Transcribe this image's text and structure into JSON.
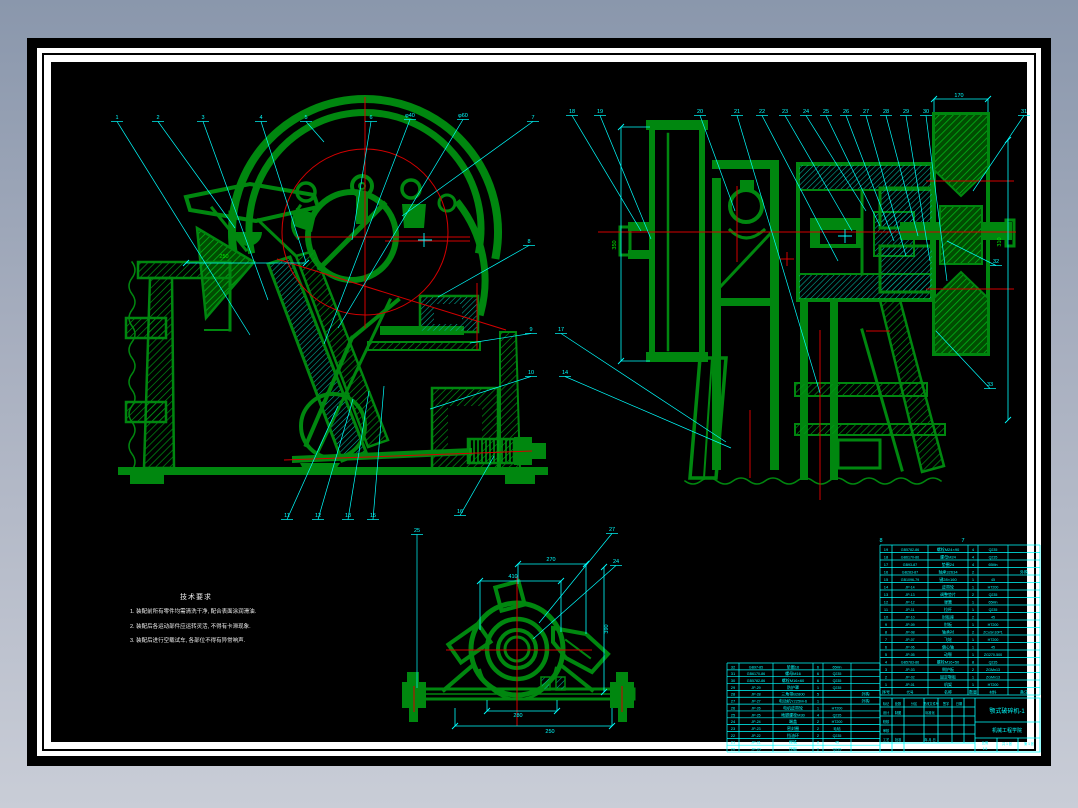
{
  "colors": {
    "green": "#00870f",
    "bright_green": "#00e800",
    "red": "#d40000",
    "cyan": "#00ffff",
    "white": "#f2f2f2",
    "desktop_top": "#8a97ac",
    "desktop_bottom": "#c9cdd7",
    "paper": "#000000"
  },
  "notes": {
    "title": "技术要求",
    "lines": [
      "1. 装配前所有零件均需清洗干净, 配合表面涂润滑油.",
      "2. 装配后各运动部件应运转灵活, 不得有卡滞现象.",
      "3. 装配后进行空载试车, 各部位不得有异常响声."
    ]
  },
  "callouts": [
    {
      "t": "1",
      "x": 117,
      "y": 119,
      "ex": 250,
      "ey": 335
    },
    {
      "t": "2",
      "x": 158,
      "y": 119,
      "ex": 235,
      "ey": 228
    },
    {
      "t": "3",
      "x": 203,
      "y": 119,
      "ex": 268,
      "ey": 300
    },
    {
      "t": "4",
      "x": 261,
      "y": 119,
      "ex": 306,
      "ey": 262
    },
    {
      "t": "5",
      "x": 306,
      "y": 119,
      "ex": 324,
      "ey": 142
    },
    {
      "t": "6",
      "x": 371,
      "y": 119,
      "ex": 352,
      "ey": 240
    },
    {
      "t": "φ40",
      "x": 410,
      "y": 117,
      "ex": 324,
      "ey": 344
    },
    {
      "t": "φ60",
      "x": 463,
      "y": 117,
      "ex": 338,
      "ey": 328
    },
    {
      "t": "7",
      "x": 533,
      "y": 119,
      "ex": 402,
      "ey": 216
    },
    {
      "t": "8",
      "x": 529,
      "y": 243,
      "ex": 438,
      "ey": 297
    },
    {
      "t": "9",
      "x": 531,
      "y": 331,
      "ex": 470,
      "ey": 343
    },
    {
      "t": "10",
      "x": 531,
      "y": 374,
      "ex": 430,
      "ey": 409
    },
    {
      "t": "17",
      "x": 561,
      "y": 331,
      "ex": 726,
      "ey": 442
    },
    {
      "t": "14",
      "x": 565,
      "y": 374,
      "ex": 731,
      "ey": 448
    },
    {
      "t": "11",
      "x": 287,
      "y": 517,
      "ex": 338,
      "ey": 406
    },
    {
      "t": "12",
      "x": 318,
      "y": 517,
      "ex": 353,
      "ey": 399
    },
    {
      "t": "13",
      "x": 348,
      "y": 517,
      "ex": 369,
      "ey": 391
    },
    {
      "t": "15",
      "x": 373,
      "y": 517,
      "ex": 384,
      "ey": 386
    },
    {
      "t": "16",
      "x": 460,
      "y": 513,
      "ex": 494,
      "ey": 456
    },
    {
      "t": "18",
      "x": 572,
      "y": 113,
      "ex": 641,
      "ey": 231
    },
    {
      "t": "19",
      "x": 600,
      "y": 113,
      "ex": 651,
      "ey": 239
    },
    {
      "t": "20",
      "x": 700,
      "y": 113,
      "ex": 735,
      "ey": 211
    },
    {
      "t": "21",
      "x": 737,
      "y": 113,
      "ex": 820,
      "ey": 393
    },
    {
      "t": "22",
      "x": 762,
      "y": 113,
      "ex": 838,
      "ey": 261
    },
    {
      "t": "23",
      "x": 785,
      "y": 113,
      "ex": 852,
      "ey": 231
    },
    {
      "t": "24",
      "x": 806,
      "y": 113,
      "ex": 866,
      "ey": 211
    },
    {
      "t": "25",
      "x": 826,
      "y": 113,
      "ex": 880,
      "ey": 226
    },
    {
      "t": "26",
      "x": 846,
      "y": 113,
      "ex": 894,
      "ey": 241
    },
    {
      "t": "27",
      "x": 866,
      "y": 113,
      "ex": 906,
      "ey": 256
    },
    {
      "t": "28",
      "x": 886,
      "y": 113,
      "ex": 918,
      "ey": 236
    },
    {
      "t": "29",
      "x": 906,
      "y": 113,
      "ex": 930,
      "ey": 261
    },
    {
      "t": "30",
      "x": 926,
      "y": 113,
      "ex": 947,
      "ey": 281
    },
    {
      "t": "31",
      "x": 1024,
      "y": 113,
      "ex": 973,
      "ey": 191
    },
    {
      "t": "32",
      "x": 996,
      "y": 263,
      "ex": 947,
      "ey": 241
    },
    {
      "t": "33",
      "x": 990,
      "y": 386,
      "ex": 936,
      "ey": 331
    },
    {
      "t": "25",
      "x": 417,
      "y": 532,
      "ex": 417,
      "ey": 688
    },
    {
      "t": "27",
      "x": 612,
      "y": 531,
      "ex": 539,
      "ey": 623
    },
    {
      "t": "24",
      "x": 616,
      "y": 563,
      "ex": 533,
      "ey": 639
    }
  ],
  "dims": [
    {
      "t": "250",
      "x": 224,
      "y": 258,
      "c": "#00e800"
    },
    {
      "t": "350",
      "x": 616,
      "y": 245,
      "c": "#00e800",
      "r": -90
    },
    {
      "t": "310",
      "x": 1001,
      "y": 242,
      "c": "#00e800",
      "r": -90
    },
    {
      "t": "170",
      "x": 959,
      "y": 97
    },
    {
      "t": "270",
      "x": 551,
      "y": 561
    },
    {
      "t": "410",
      "x": 513,
      "y": 578
    },
    {
      "t": "390",
      "x": 608,
      "y": 629,
      "r": -90
    },
    {
      "t": "280",
      "x": 518,
      "y": 717
    },
    {
      "t": "250",
      "x": 550,
      "y": 733
    },
    {
      "t": "8",
      "x": 881,
      "y": 542
    },
    {
      "t": "7",
      "x": 963,
      "y": 542
    }
  ],
  "parts_table": {
    "x": 880,
    "y": 545,
    "row_h": 7.5,
    "cols": [
      12,
      36,
      40,
      10,
      30,
      32
    ],
    "header": [
      "序号",
      "代号",
      "名称",
      "数量",
      "材料",
      "备注"
    ],
    "rows": [
      [
        "19",
        "GB5782-86",
        "螺栓M24×90",
        "4",
        "Q235",
        ""
      ],
      [
        "18",
        "GB6170-86",
        "螺母M24",
        "4",
        "Q235",
        ""
      ],
      [
        "17",
        "GB93-87",
        "垫圈24",
        "4",
        "65Mn",
        ""
      ],
      [
        "16",
        "GB283-87",
        "轴承32634",
        "2",
        "",
        "外购"
      ],
      [
        "15",
        "GB1096-79",
        "键28×160",
        "1",
        "45",
        ""
      ],
      [
        "14",
        "JP-14",
        "皮带轮",
        "1",
        "HT200",
        ""
      ],
      [
        "13",
        "JP-13",
        "调整垫片",
        "2",
        "Q235",
        ""
      ],
      [
        "12",
        "JP-12",
        "弹簧",
        "1",
        "65Mn",
        ""
      ],
      [
        "11",
        "JP-11",
        "拉杆",
        "1",
        "Q235",
        ""
      ],
      [
        "10",
        "JP-10",
        "肘板座",
        "2",
        "45",
        ""
      ],
      [
        "9",
        "JP-09",
        "肘板",
        "1",
        "HT200",
        ""
      ],
      [
        "8",
        "JP-08",
        "轴承衬",
        "2",
        "ZCuSn10P1",
        ""
      ],
      [
        "7",
        "JP-07",
        "飞轮",
        "1",
        "HT200",
        ""
      ],
      [
        "6",
        "JP-06",
        "偏心轴",
        "1",
        "45",
        ""
      ],
      [
        "5",
        "JP-05",
        "动颚",
        "1",
        "ZG270-500",
        ""
      ],
      [
        "4",
        "GB5783-86",
        "螺栓M16×50",
        "8",
        "Q235",
        ""
      ],
      [
        "3",
        "JP-03",
        "侧护板",
        "2",
        "ZGMn13",
        ""
      ],
      [
        "2",
        "JP-02",
        "固定颚板",
        "1",
        "ZGMn13",
        ""
      ],
      [
        "1",
        "JP-01",
        "机架",
        "1",
        "HT200",
        ""
      ]
    ]
  },
  "parts_table2": {
    "x": 727,
    "y": 663,
    "row_h": 6.85,
    "cols": [
      12,
      34,
      40,
      10,
      28,
      29
    ],
    "rows": [
      [
        "32",
        "GB97-85",
        "垫圈16",
        "6",
        "65Mn",
        ""
      ],
      [
        "31",
        "GB6170-86",
        "螺母M16",
        "6",
        "Q235",
        ""
      ],
      [
        "30",
        "GB5782-86",
        "螺栓M16×60",
        "6",
        "Q235",
        ""
      ],
      [
        "29",
        "JP-29",
        "防护罩",
        "1",
        "Q235",
        ""
      ],
      [
        "28",
        "JP-28",
        "三角带B2800",
        "5",
        "",
        "外购"
      ],
      [
        "27",
        "JP-27",
        "电动机Y225M-6",
        "1",
        "",
        "外购"
      ],
      [
        "26",
        "JP-26",
        "电机皮带轮",
        "1",
        "HT200",
        ""
      ],
      [
        "25",
        "JP-25",
        "地脚螺栓M30",
        "4",
        "Q235",
        ""
      ],
      [
        "24",
        "JP-24",
        "端盖",
        "2",
        "HT200",
        ""
      ],
      [
        "23",
        "JP-23",
        "密封圈",
        "2",
        "毛毡",
        ""
      ],
      [
        "22",
        "JP-22",
        "挡油环",
        "2",
        "Q235",
        ""
      ],
      [
        "21",
        "JP-21",
        "楔铁",
        "2",
        "45",
        ""
      ],
      [
        "20",
        "JP-20",
        "压板",
        "2",
        "Q235",
        ""
      ]
    ]
  },
  "title_block": {
    "name": "颚式破碎机-1",
    "org": "机械工程学院",
    "cells": [
      {
        "x": 886,
        "y": 705,
        "t": "标记"
      },
      {
        "x": 898,
        "y": 705,
        "t": "处数"
      },
      {
        "x": 914,
        "y": 705,
        "t": "分区"
      },
      {
        "x": 931,
        "y": 705,
        "t": "更改文件号"
      },
      {
        "x": 946,
        "y": 705,
        "t": "签字"
      },
      {
        "x": 959,
        "y": 705,
        "t": "日期"
      },
      {
        "x": 886,
        "y": 714,
        "t": "设计"
      },
      {
        "x": 898,
        "y": 714,
        "t": "制图"
      },
      {
        "x": 930,
        "y": 714,
        "t": "标准化"
      },
      {
        "x": 886,
        "y": 723,
        "t": "校核"
      },
      {
        "x": 886,
        "y": 732,
        "t": "审核"
      },
      {
        "x": 886,
        "y": 741,
        "t": "工艺"
      },
      {
        "x": 898,
        "y": 741,
        "t": "批准"
      },
      {
        "x": 930,
        "y": 741,
        "t": "年.月.日"
      },
      {
        "x": 985,
        "y": 744,
        "t": "比例"
      },
      {
        "x": 985,
        "y": 750,
        "t": "1:5"
      },
      {
        "x": 1007,
        "y": 745,
        "t": "共 1 张"
      },
      {
        "x": 1029,
        "y": 745,
        "t": "第 1 张"
      }
    ]
  }
}
